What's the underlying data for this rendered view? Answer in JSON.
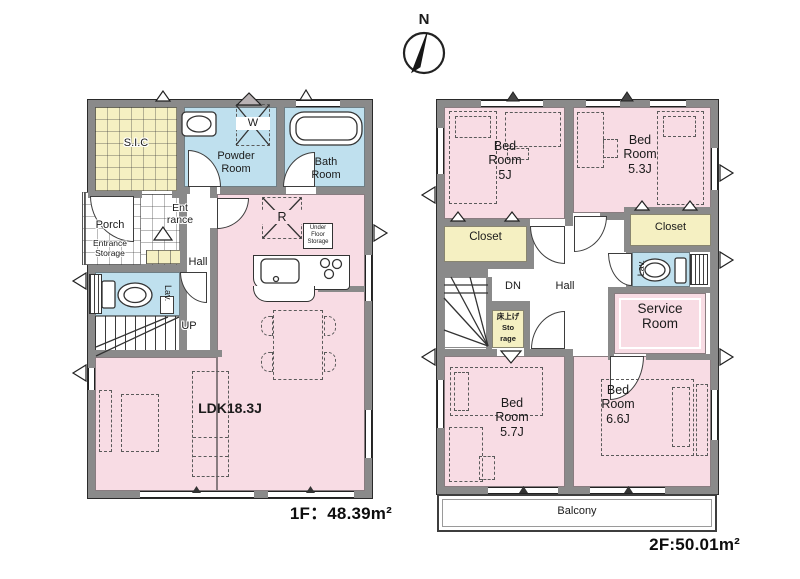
{
  "compass": {
    "north": "N"
  },
  "colors": {
    "pink": "#f8dce4",
    "yellow": "#f5f0c2",
    "blue": "#bfe0ee",
    "wall": "#8a8a8a"
  },
  "floor1": {
    "area_label": "1F：48.39m²",
    "rooms": {
      "sic": "S.I.C",
      "powder": "Powder\nRoom",
      "bath": "Bath\nRoom",
      "porch": "Porch",
      "entrance": "Ent\nrance",
      "entrance_storage": "Entrance\nStorage",
      "hall": "Hall",
      "lav": "Lav.",
      "up": "UP",
      "washer": "W",
      "fridge": "R",
      "under_floor_storage": "Under\nFloor\nStorage",
      "ldk": "LDK18.3J"
    }
  },
  "floor2": {
    "area_label": "2F:50.01m²",
    "rooms": {
      "bedroom_5j": "Bed\nRoom\n5J",
      "bedroom_53j": "Bed\nRoom\n5.3J",
      "closet_left": "Closet",
      "closet_right": "Closet",
      "lav": "Lav.",
      "dn": "DN",
      "hall": "Hall",
      "raised_storage": "床上げ\nSto\nrage",
      "service": "Service\nRoom",
      "bedroom_57j": "Bed\nRoom\n5.7J",
      "bedroom_66j": "Bed\nRoom\n6.6J",
      "balcony": "Balcony"
    }
  }
}
